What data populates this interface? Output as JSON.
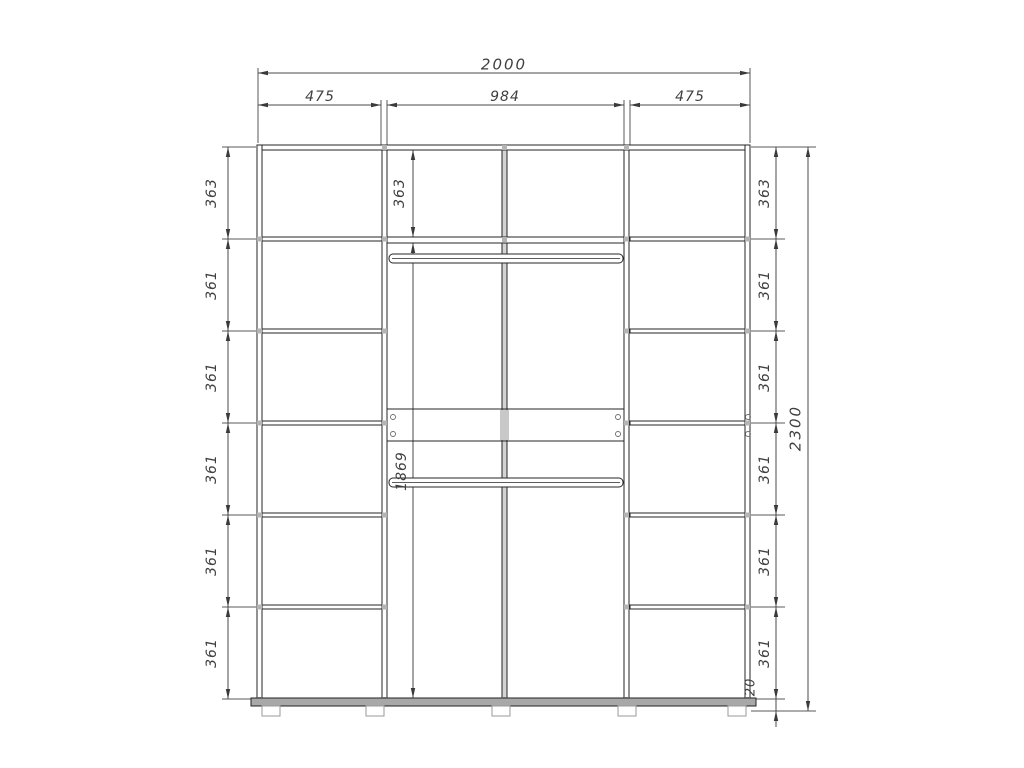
{
  "labels": {
    "total_width": "2000",
    "left_section_width": "475",
    "center_section_width": "984",
    "right_section_width": "475",
    "total_height": "2300",
    "center_top_shelf_height": "363",
    "center_opening_height": "1869",
    "plinth_height": "20",
    "left_rows": [
      "363",
      "361",
      "361",
      "361",
      "361",
      "361"
    ],
    "right_rows": [
      "363",
      "361",
      "361",
      "361",
      "361",
      "361"
    ]
  },
  "colors": {
    "structure_line": "#262626",
    "dimension_line": "#4a4a4a",
    "hardware_fill": "#b4b4b4",
    "panel_fill": "#d4d4d4"
  }
}
